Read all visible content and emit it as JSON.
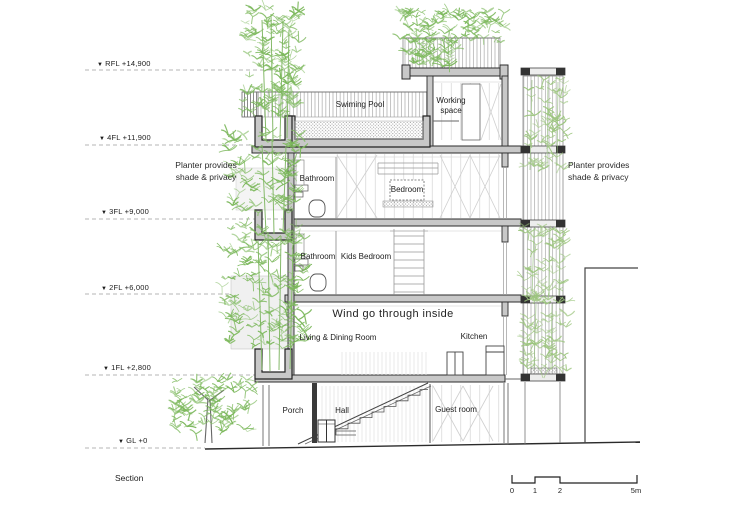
{
  "drawing_title": "Section",
  "levels": [
    {
      "mark": "▼",
      "name": "RFL",
      "label": "RFL +14,900"
    },
    {
      "mark": "▼",
      "name": "4FL",
      "label": "4FL +11,900"
    },
    {
      "mark": "▼",
      "name": "3FL",
      "label": "3FL +9,000"
    },
    {
      "mark": "▼",
      "name": "2FL",
      "label": "2FL +6,000"
    },
    {
      "mark": "▼",
      "name": "1FL",
      "label": "1FL +2,800"
    },
    {
      "mark": "▼",
      "name": "GL",
      "label": "GL +0"
    }
  ],
  "rooms": {
    "swimming_pool": "Swiming Pool",
    "working_space": "Working space",
    "bathroom_4f": "Bathroom",
    "bedroom": "Bedroom",
    "bathroom_3f": "Bathroom",
    "kids_bedroom": "Kids Bedroom",
    "living_dining": "Living & Dining Room",
    "kitchen": "Kitchen",
    "porch": "Porch",
    "hall": "Hall",
    "guest_room": "Guest room"
  },
  "annotations": {
    "wind": "Wind go through inside",
    "planter_left": "Planter provides shade & privacy",
    "planter_right": "Planter provides shade & privacy"
  },
  "scale_bar": {
    "ticks": [
      "0",
      "1",
      "2",
      "5m"
    ]
  },
  "palette": {
    "foliage": "#7cb85c",
    "foliage_light": "#9cc57e",
    "slab_fill": "#c8c8c8",
    "line": "#2b2b2b"
  }
}
